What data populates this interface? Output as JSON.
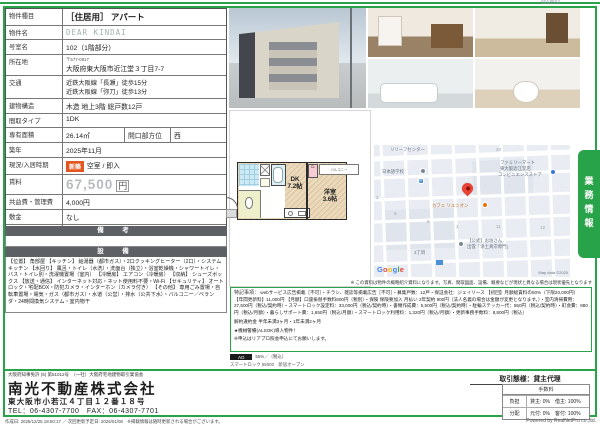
{
  "meta": {
    "doc_code": "9018561"
  },
  "table": {
    "rows": [
      {
        "label": "物件種目",
        "value": "［住居用］ アパート"
      },
      {
        "label": "物件名",
        "value": "DEAR KINDAI"
      },
      {
        "label": "号室名",
        "value": "102（1階部分）"
      },
      {
        "label": "所在地",
        "zip": "〒577-0817",
        "value": "大阪府東大阪市近江堂３丁目7-7"
      },
      {
        "label": "交通",
        "line1": "近鉄大阪線「長瀬」徒歩15分",
        "line2": "近鉄大阪線「弥刀」徒歩13分"
      },
      {
        "label": "建物構造",
        "value": "木造 地上3階 総戸数12戸"
      },
      {
        "label": "間取タイプ",
        "value": "1DK"
      },
      {
        "label": "専有面積",
        "value": "26.14㎡",
        "label2": "開口部方位",
        "value2": "西"
      },
      {
        "label": "築年",
        "value": "2025年11月"
      },
      {
        "label": "現況/入居時期",
        "badge": "新築",
        "value": "空室 / 即入"
      },
      {
        "label": "賃料",
        "value": "67,500",
        "unit": "円"
      },
      {
        "label": "共益費・管理費",
        "value": "4,000円"
      },
      {
        "label": "敷金",
        "value": "なし"
      },
      {
        "label": "礼金",
        "value": "1ヶ月"
      },
      {
        "label": "保証金",
        "value": "なし",
        "label2": "償却・敷引",
        "value2": "なし"
      },
      {
        "label": "更新料",
        "value": ""
      },
      {
        "label": "契約期間",
        "value": "1年間"
      },
      {
        "label": "町内会費",
        "value": ""
      },
      {
        "label": "駐車場",
        "value": "なし"
      }
    ]
  },
  "sections": {
    "remarks_title": "備　考",
    "equipment_title": "設　備"
  },
  "equipment": {
    "text": "【位置】 角部屋 【キッチン】 給湯器（都市ガス）・2口クッキングヒーター（2口）・システムキッチン 【水回り】 風呂・トイレ（水洗）・洗面台（独立）・浴室乾燥機・シャワートイレ・バス・トイレ別・洗濯機置場（室内） 【冷暖房】 エアコン（冷暖房） 【収納】 シューズボックス 【放送・通信】 インターネット対応・ネット使用料不要・Wi-Fi 【セキュリティ】 オートロック・宅配BOX・防犯カメラ・インターホン（カメラ付き） 【その他】 専用ごみ置場・自転車置場・電気・ガス（都市ガス）・水道（公営）・排水（公共下水）・バルコニー／ベランダ・24時間換気システム・室内物干"
  },
  "disclaimer": "※ この資料は物件の概略紹介資料になります。写真、間取図面、設備、概要などが現状と異なる場合は現状優先となります",
  "notes": {
    "label": "特記事項：",
    "body1": "webサービス広告掲載［不可］・チラシ、雑誌等掲載広告［不可］・募集戸数：12戸・保証会社：ジェイリース 【初回】月額総賃料の50%（下限20,000円） 【年間更新料】11,000円 【月額】口座振替手数料800円（税別）・保険 保険要加入 月払い 2年契約 900円（法人名義の場合は金額が変更となります。）・室内清掃費用：27,500円（税込/契約時）・スマートロック設定料：33,000円（税込/契約時）・書類作成費：5,500円（税込/契約時）・駐輪ステッカー代：550円（税込/契約時）・町会費：880円（税込/月額）・暮らしサポート費：1,650円（税込/月額）・スマートロック利用料：1,320円（税込/月額）・更新事務手数料：8,800円（税込）",
    "body2": "解約違約金 半年未満3ヶ月・1年未満2ヶ月",
    "body3": "★機械警備(ALSOK)導入物件！",
    "body4": "※申込はリアプロ照会申込にてお願いします。"
  },
  "ad": {
    "label": "AD",
    "value": "55%／（税込）",
    "line2": "スマートロック 55000　新居オープン"
  },
  "floor_plan": {
    "dk_name": "DK",
    "dk_size": "7.2帖",
    "room_name": "洋室",
    "room_size": "3.6帖",
    "closet": "CL",
    "balcony": "バルコニー"
  },
  "map": {
    "relief": "リリーフセンター",
    "school": "日本語学校",
    "parking": "P",
    "familymart_1": "ファミリーマート",
    "familymart_2": "東大阪近江堂店",
    "familymart_3": "コンビニエンスストア",
    "cafe": "カフェ リユニオン",
    "temple_1": "【公式】お坊さん",
    "temple_2": "出雲「浄土真宗専門」",
    "district": "3丁目",
    "numbers": {
      "n1": "1",
      "n2": "2",
      "n5": "5",
      "n6": "6",
      "n11": "11",
      "n12": "12",
      "n24": "24"
    },
    "google": "Google",
    "copyright": "Map data ©2025"
  },
  "side_tab": {
    "label": "業務情報"
  },
  "company": {
    "license": "大阪府知事免許 (5) 第51012号　（一社）大阪府宅地建物取引業協会",
    "name": "南光不動産株式会社",
    "address": "東大阪市小若江４丁目１２番１８号",
    "tel_fax": "TEL：06-4307-7700　FAX：06-4307-7701"
  },
  "dealing": {
    "type": "取引態様：貸主代理",
    "fee_title": "手数料",
    "rows": [
      {
        "label": "負担",
        "value": "貸主: 0%　借主: 100%"
      },
      {
        "label": "分配",
        "value": "元付: 0%　客付: 100%"
      }
    ]
  },
  "footer": {
    "left": "作成日: 2025/12/25 18:50:17 ／ 次回更新予定日: 2026/01/08　※掲載情報は随時更新される場合がございます。",
    "right": "Powered by RealNetPro co.,ltd."
  }
}
